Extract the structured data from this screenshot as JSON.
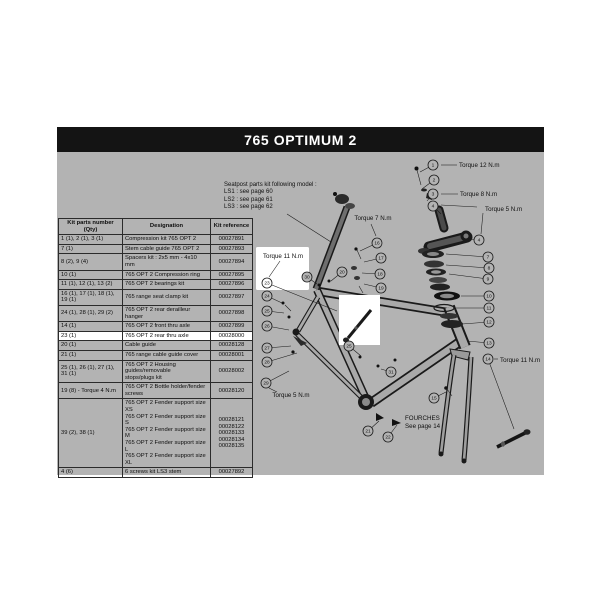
{
  "title": "765 OPTIMUM 2",
  "note": {
    "line0": "Seatpost parts kit following model :",
    "line1": "LS1 : see page 60",
    "line2": "LS2 : see page 61",
    "line3": "LS3 : see page 62"
  },
  "table": {
    "headers": [
      "Kit parts number (Qty)",
      "Designation",
      "Kit reference"
    ],
    "rows": [
      {
        "parts": "1 (1), 2 (1), 3 (1)",
        "designation": "Compression kit 765 OPT 2",
        "reference": "00027891",
        "highlight": false
      },
      {
        "parts": "7 (1)",
        "designation": "Stem cable guide 765 OPT 2",
        "reference": "00027893",
        "highlight": false
      },
      {
        "parts": "8 (2), 9 (4)",
        "designation": "Spacers kit : 2x5 mm - 4x10 mm",
        "reference": "00027894",
        "highlight": false
      },
      {
        "parts": "10 (1)",
        "designation": "765 OPT 2 Compression ring",
        "reference": "00027895",
        "highlight": false
      },
      {
        "parts": "11 (1), 12 (1), 13 (2)",
        "designation": "765 OPT 2 bearings kit",
        "reference": "00027896",
        "highlight": false
      },
      {
        "parts": "16 (1), 17 (1), 18 (1), 19 (1)",
        "designation": "765 range seat clamp kit",
        "reference": "00027897",
        "highlight": false
      },
      {
        "parts": "24 (1), 28 (1), 29 (2)",
        "designation": "765 OPT 2 rear derailleur hanger",
        "reference": "00027898",
        "highlight": false
      },
      {
        "parts": "14 (1)",
        "designation": "765 OPT 2 front thru axle",
        "reference": "00027899",
        "highlight": false
      },
      {
        "parts": "23 (1)",
        "designation": "765 OPT 2 rear thru axle",
        "reference": "00028000",
        "highlight": true
      },
      {
        "parts": "20 (1)",
        "designation": "Cable guide",
        "reference": "00028128",
        "highlight": false
      },
      {
        "parts": "21 (1)",
        "designation": "765 range cable guide cover",
        "reference": "00028001",
        "highlight": false
      },
      {
        "parts": "25 (1), 26 (1), 27 (1), 31 (1)",
        "designation": "765 OPT 2 Housing guides/removable\nstops/plugs kit",
        "reference": "00028002",
        "highlight": false
      },
      {
        "parts": "19 (8) - Torque 4 N.m",
        "designation": "765 OPT 2 Bottle holder/fender screws",
        "reference": "00028120",
        "highlight": false
      },
      {
        "parts": "39 (2), 38 (1)",
        "designation": [
          "765 OPT 2 Fender support size XS",
          "765 OPT 2 Fender support size S",
          "765 OPT 2 Fender support size M",
          "765 OPT 2 Fender support size L",
          "765 OPT 2 Fender support size XL"
        ],
        "reference": [
          "00028121",
          "00028122",
          "00028133",
          "00028134",
          "00028135"
        ],
        "highlight": false
      },
      {
        "parts": "4 (6)",
        "designation": "6 screws kit LS3 stem",
        "reference": "00027892",
        "highlight": false
      }
    ]
  },
  "diagram": {
    "fourches": [
      "FOURCHES",
      "See page 14"
    ],
    "torque_labels": [
      {
        "text": "Torque 12 N.m",
        "x": 459,
        "y": 167,
        "anchor": "start",
        "leader": [
          457,
          165,
          441,
          165
        ]
      },
      {
        "text": "Torque 8 N.m",
        "x": 460,
        "y": 196,
        "anchor": "start",
        "leader": [
          458,
          194,
          441,
          194
        ]
      },
      {
        "text": "Torque 5 N.m",
        "x": 485,
        "y": 211,
        "anchor": "start",
        "leader": [
          483,
          213,
          481,
          234
        ]
      },
      {
        "text": "Torque 7 N.m",
        "x": 373,
        "y": 220,
        "anchor": "middle",
        "leader": [
          371,
          224,
          376,
          236
        ]
      },
      {
        "text": "Torque 11 N.m",
        "x": 283,
        "y": 258,
        "anchor": "middle",
        "leader": [
          280,
          261,
          269,
          277
        ]
      },
      {
        "text": "Torque 11 N.m",
        "x": 500,
        "y": 362,
        "anchor": "start",
        "leader": [
          498,
          359,
          494,
          359
        ]
      },
      {
        "text": "Torque 5 N.m",
        "x": 291,
        "y": 397,
        "anchor": "middle",
        "leader": [
          269,
          388,
          277,
          392
        ]
      }
    ],
    "callouts": [
      {
        "n": "1",
        "x": 433,
        "y": 165,
        "lx": 420,
        "ly": 172,
        "hl": false
      },
      {
        "n": "2",
        "x": 434,
        "y": 180,
        "lx": 422,
        "ly": 189,
        "hl": false
      },
      {
        "n": "3",
        "x": 433,
        "y": 194,
        "lx": 427,
        "ly": 201,
        "hl": false
      },
      {
        "n": "4",
        "x": 433,
        "y": 206,
        "lx": 441,
        "ly": 214,
        "hl": false
      },
      {
        "n": "4",
        "x": 479,
        "y": 240,
        "lx": 468,
        "ly": 239,
        "hl": false
      },
      {
        "n": "7",
        "x": 488,
        "y": 257,
        "lx": 446,
        "ly": 254,
        "hl": false
      },
      {
        "n": "8",
        "x": 489,
        "y": 268,
        "lx": 446,
        "ly": 265,
        "hl": false
      },
      {
        "n": "9",
        "x": 488,
        "y": 279,
        "lx": 449,
        "ly": 274,
        "hl": false
      },
      {
        "n": "10",
        "x": 489,
        "y": 296,
        "lx": 461,
        "ly": 296,
        "hl": false
      },
      {
        "n": "11",
        "x": 489,
        "y": 308,
        "lx": 456,
        "ly": 308,
        "hl": false
      },
      {
        "n": "12",
        "x": 489,
        "y": 322,
        "lx": 462,
        "ly": 324,
        "hl": false
      },
      {
        "n": "13",
        "x": 489,
        "y": 343,
        "lx": 467,
        "ly": 341,
        "hl": false
      },
      {
        "n": "14",
        "x": 488,
        "y": 359,
        "lx": 514,
        "ly": 429,
        "hl": false
      },
      {
        "n": "15",
        "x": 434,
        "y": 398,
        "lx": 446,
        "ly": 392,
        "hl": false
      },
      {
        "n": "16",
        "x": 377,
        "y": 243,
        "lx": 360,
        "ly": 251,
        "hl": false
      },
      {
        "n": "17",
        "x": 381,
        "y": 258,
        "lx": 364,
        "ly": 262,
        "hl": false
      },
      {
        "n": "18",
        "x": 380,
        "y": 274,
        "lx": 362,
        "ly": 273,
        "hl": false
      },
      {
        "n": "19",
        "x": 381,
        "y": 288,
        "lx": 364,
        "ly": 284,
        "hl": false
      },
      {
        "n": "20",
        "x": 342,
        "y": 272,
        "lx": 331,
        "ly": 281,
        "hl": false
      },
      {
        "n": "30",
        "x": 307,
        "y": 277,
        "lx": 317,
        "ly": 284,
        "hl": false
      },
      {
        "n": "23",
        "x": 267,
        "y": 283,
        "lx": 337,
        "ly": 311,
        "hl": true
      },
      {
        "n": "24",
        "x": 267,
        "y": 296,
        "lx": 282,
        "ly": 303,
        "hl": false
      },
      {
        "n": "25",
        "x": 267,
        "y": 311,
        "lx": 284,
        "ly": 313,
        "hl": false
      },
      {
        "n": "26",
        "x": 267,
        "y": 326,
        "lx": 289,
        "ly": 330,
        "hl": false
      },
      {
        "n": "27",
        "x": 267,
        "y": 348,
        "lx": 291,
        "ly": 346,
        "hl": false
      },
      {
        "n": "28",
        "x": 267,
        "y": 362,
        "lx": 297,
        "ly": 353,
        "hl": false
      },
      {
        "n": "29",
        "x": 266,
        "y": 383,
        "lx": 289,
        "ly": 371,
        "hl": false
      },
      {
        "n": "25",
        "x": 349,
        "y": 346,
        "lx": 361,
        "ly": 356,
        "hl": false
      },
      {
        "n": "31",
        "x": 391,
        "y": 372,
        "lx": 381,
        "ly": 369,
        "hl": false
      },
      {
        "n": "21",
        "x": 368,
        "y": 431,
        "lx": 379,
        "ly": 421,
        "hl": false
      },
      {
        "n": "22",
        "x": 388,
        "y": 437,
        "lx": 397,
        "ly": 425,
        "hl": false
      }
    ]
  },
  "colors": {
    "titlebar": "#141414",
    "canvas": "#b3b3b3",
    "highlight": "#ffffff",
    "ink": "#1a1a1a"
  }
}
